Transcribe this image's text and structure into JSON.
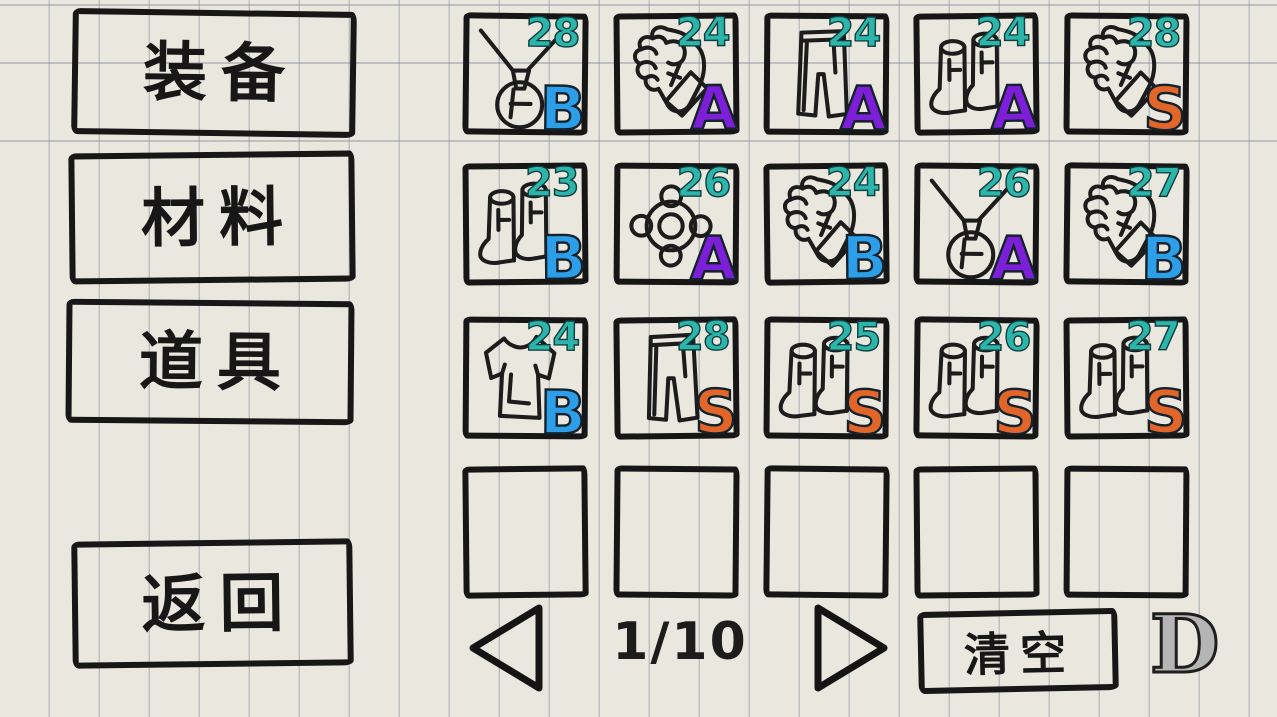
{
  "colors": {
    "paper": "#eae7de",
    "ink": "#171717",
    "level_number": "#2db4ab",
    "grades": {
      "B": "#2d9ee8",
      "A": "#7d1fd8",
      "S": "#e2662a"
    },
    "d_badge_fill": "#b5b5b5"
  },
  "sidebar": {
    "equipment_label": "装备",
    "materials_label": "材料",
    "items_label": "道具",
    "back_label": "返回"
  },
  "inventory": {
    "columns": 5,
    "rows": 4,
    "slots": [
      {
        "icon": "necklace",
        "level": "28",
        "grade": "B"
      },
      {
        "icon": "fist",
        "level": "24",
        "grade": "A"
      },
      {
        "icon": "pants",
        "level": "24",
        "grade": "A"
      },
      {
        "icon": "boots",
        "level": "24",
        "grade": "A"
      },
      {
        "icon": "fist",
        "level": "28",
        "grade": "S"
      },
      {
        "icon": "boots",
        "level": "23",
        "grade": "B"
      },
      {
        "icon": "ring",
        "level": "26",
        "grade": "A"
      },
      {
        "icon": "fist",
        "level": "24",
        "grade": "B"
      },
      {
        "icon": "necklace",
        "level": "26",
        "grade": "A"
      },
      {
        "icon": "fist",
        "level": "27",
        "grade": "B"
      },
      {
        "icon": "shirt",
        "level": "24",
        "grade": "B"
      },
      {
        "icon": "pants",
        "level": "28",
        "grade": "S"
      },
      {
        "icon": "boots",
        "level": "25",
        "grade": "S"
      },
      {
        "icon": "boots",
        "level": "26",
        "grade": "S"
      },
      {
        "icon": "boots",
        "level": "27",
        "grade": "S"
      },
      {
        "icon": "",
        "level": "",
        "grade": ""
      },
      {
        "icon": "",
        "level": "",
        "grade": ""
      },
      {
        "icon": "",
        "level": "",
        "grade": ""
      },
      {
        "icon": "",
        "level": "",
        "grade": ""
      },
      {
        "icon": "",
        "level": "",
        "grade": ""
      }
    ]
  },
  "pagination": {
    "current_page": "1",
    "total_pages": "10",
    "label": "1/10"
  },
  "footer": {
    "clear_label": "清空",
    "d_badge": "D"
  }
}
